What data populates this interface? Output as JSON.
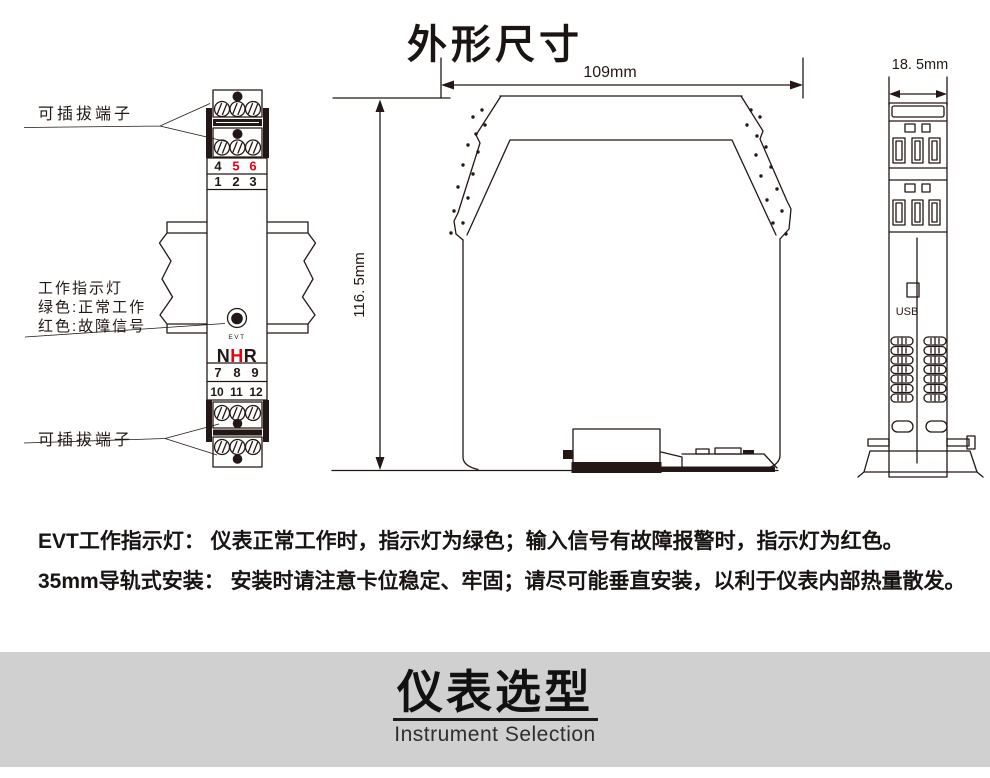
{
  "colors": {
    "accent-red": "#e60012",
    "ink": "#231815",
    "banner-gray": "#d1d0d1"
  },
  "title": "外形尺寸",
  "front_view": {
    "pluggable_label_top": "可插拔端子",
    "pluggable_label_bottom": "可插拔端子",
    "indicator": [
      "工作指示灯",
      "绿色:正常工作",
      "红色:故障信号"
    ],
    "led_label": "EVT",
    "logo": [
      "N",
      "H",
      "R"
    ],
    "numbers": {
      "row1": [
        "4",
        "5",
        "6"
      ],
      "row2": [
        "1",
        "2",
        "3"
      ],
      "row3": [
        "7",
        "8",
        "9"
      ],
      "row4": [
        "10",
        "11",
        "12"
      ]
    }
  },
  "side_view": {
    "width_dim": "109mm",
    "height_dim": "116. 5mm"
  },
  "end_view": {
    "width_dim": "18. 5mm",
    "usb_label": "USB"
  },
  "notes": [
    "EVT工作指示灯： 仪表正常工作时，指示灯为绿色；输入信号有故障报警时，指示灯为红色。",
    "35mm导轨式安装： 安装时请注意卡位稳定、牢固；请尽可能垂直安装，以利于仪表内部热量散发。"
  ],
  "banner": {
    "title": "仪表选型",
    "subtitle": "Instrument Selection"
  }
}
